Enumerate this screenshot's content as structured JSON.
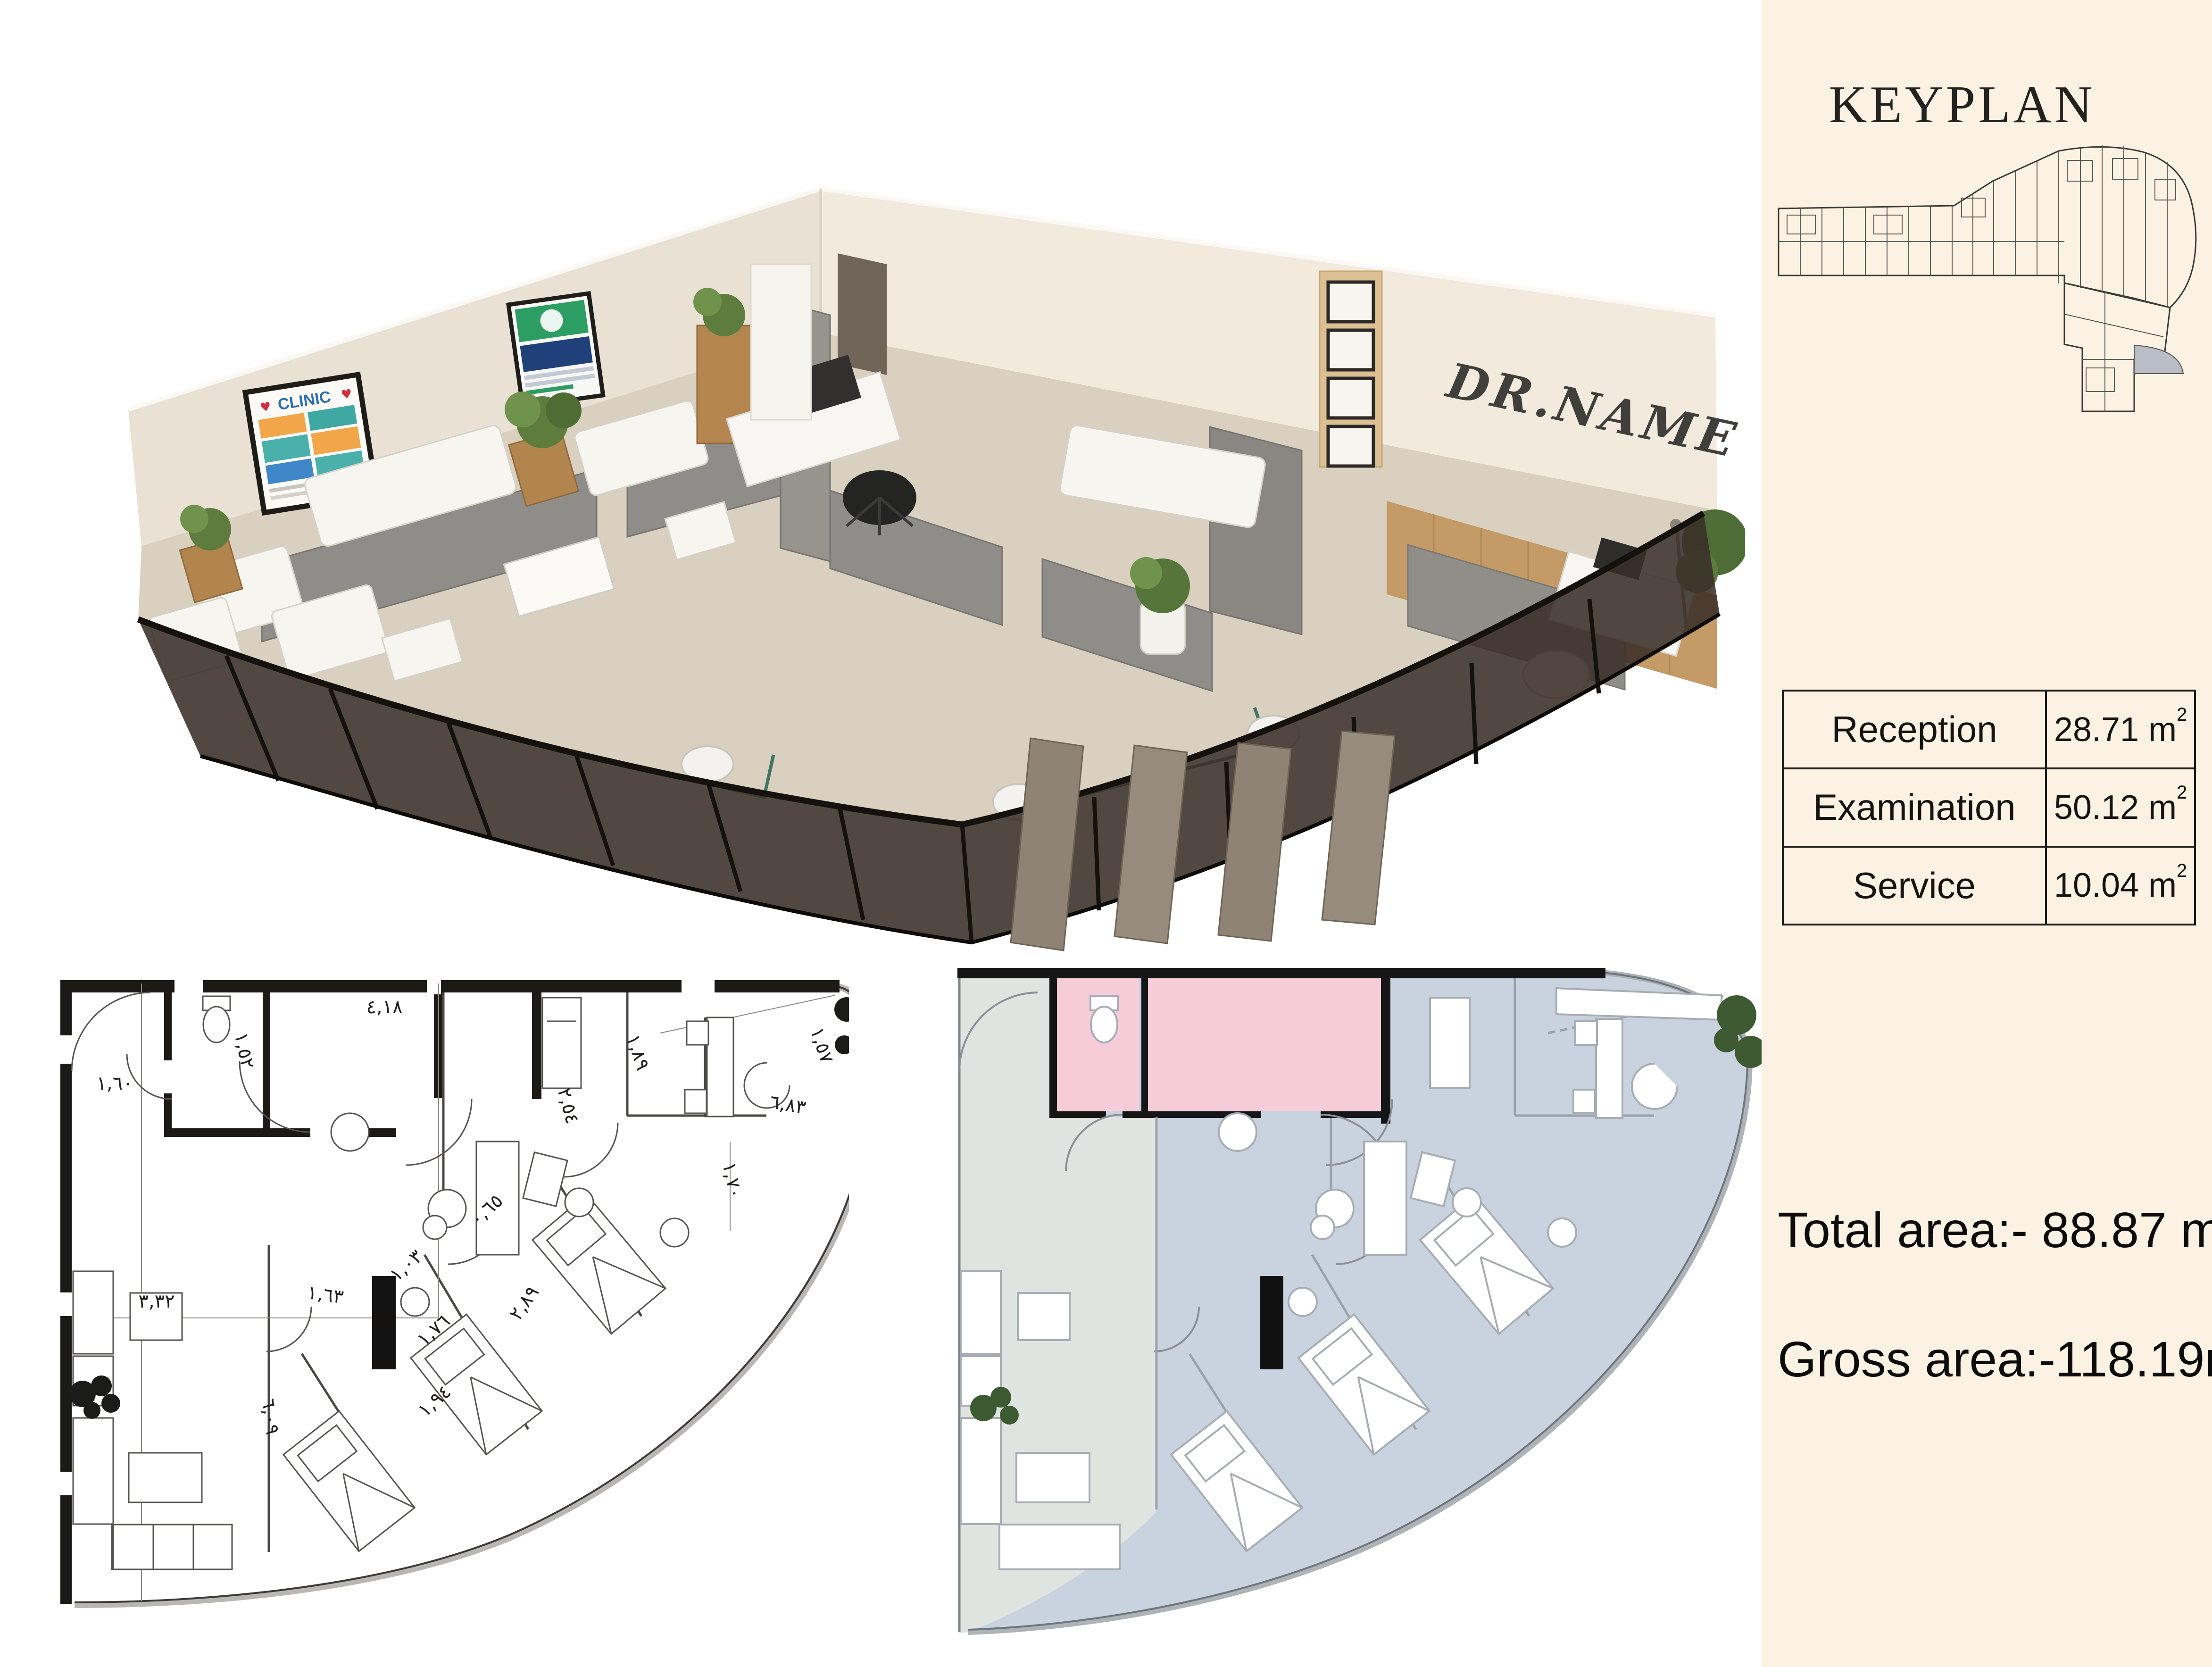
{
  "panel": {
    "background": "#fcf2e3",
    "keyplan_title": "KEYPLAN",
    "table": {
      "rows": [
        {
          "label": "Reception",
          "value": "28.71 m",
          "sup": "2"
        },
        {
          "label": "Examination",
          "value": "50.12 m",
          "sup": "2"
        },
        {
          "label": "Service",
          "value": "10.04 m",
          "sup": "2"
        }
      ]
    },
    "total_area": {
      "text": "Total area:- 88.87 m",
      "sup": "2"
    },
    "gross_area": {
      "text": "Gross area:-118.19m",
      "sup": "2"
    }
  },
  "render3d": {
    "wall_signature": "DR.NAME",
    "poster_title": "CLINIC",
    "poster_hearts": "♥"
  },
  "plan_bw": {
    "dims": [
      {
        "t": "٤,١٨"
      },
      {
        "t": "١,٥٢"
      },
      {
        "t": "١,٦٠"
      },
      {
        "t": "١,٨٩"
      },
      {
        "t": "١,٥٧"
      },
      {
        "t": "٦,٨٣"
      },
      {
        "t": "١,٧٠"
      },
      {
        "t": "٠,٦٥"
      },
      {
        "t": "١,٠٣"
      },
      {
        "t": "١,٧٦"
      },
      {
        "t": "٢,٨٩"
      },
      {
        "t": "١,٩٤"
      },
      {
        "t": "٦,٠٩"
      },
      {
        "t": "٣,٣٢"
      },
      {
        "t": "١,٦٣"
      },
      {
        "t": "٢,٥٤"
      }
    ]
  },
  "colors": {
    "cream": "#fcf2e3",
    "pink": "#f6ccd8",
    "exam_blue": "#c9d2df",
    "reception_gray": "#dfe4e1",
    "glass": "#3a2f28",
    "wood": "#c49a66",
    "partition_gray": "#8f8d89",
    "plant_green": "#5d7c3e",
    "keyplan_highlight": "#b9bdc6"
  }
}
